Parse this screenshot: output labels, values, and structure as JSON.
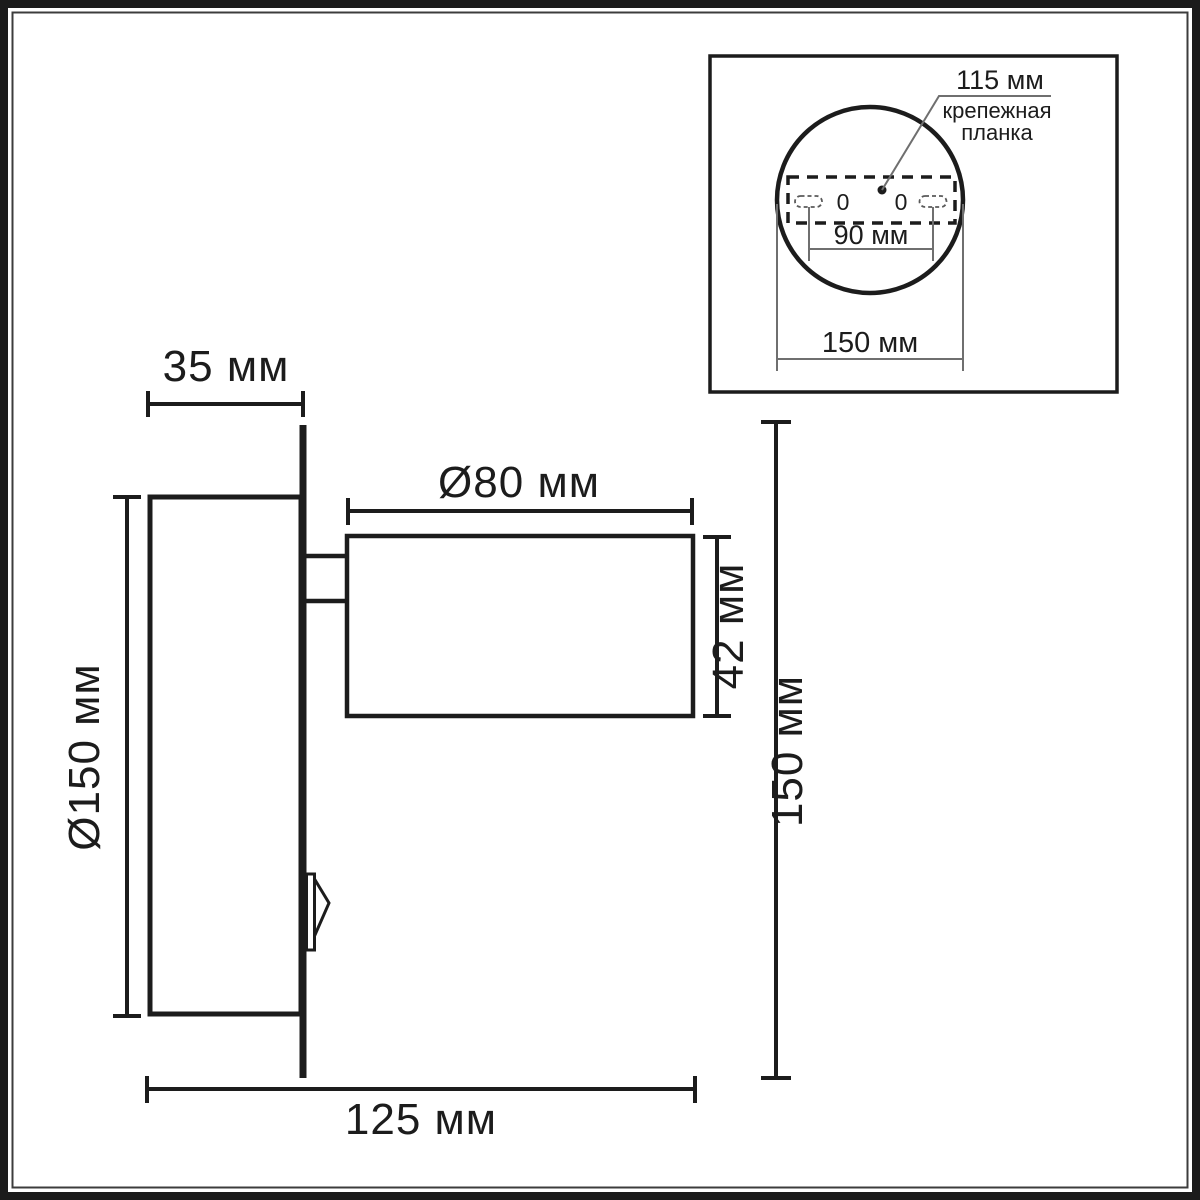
{
  "figure": {
    "kind": "technical dimension drawing of wall lamp",
    "background": "#ffffff",
    "line_color": "#1c1c1c",
    "thin_line_color": "#6f6f6f",
    "units": "мм"
  },
  "main_view": {
    "plate_depth": "35 мм",
    "plate_diameter": "Ø150 мм",
    "head_diameter": "Ø80 мм",
    "head_height": "42 мм",
    "overall_height": "150 мм",
    "overall_width": "125 мм"
  },
  "inset_view": {
    "bracket_width": "115 мм",
    "bracket_label_line1": "крепежная",
    "bracket_label_line2": "планка",
    "hole_spacing": "90 мм",
    "plate_diameter": "150 мм",
    "left_hole_mark": "0",
    "right_hole_mark": "0"
  }
}
